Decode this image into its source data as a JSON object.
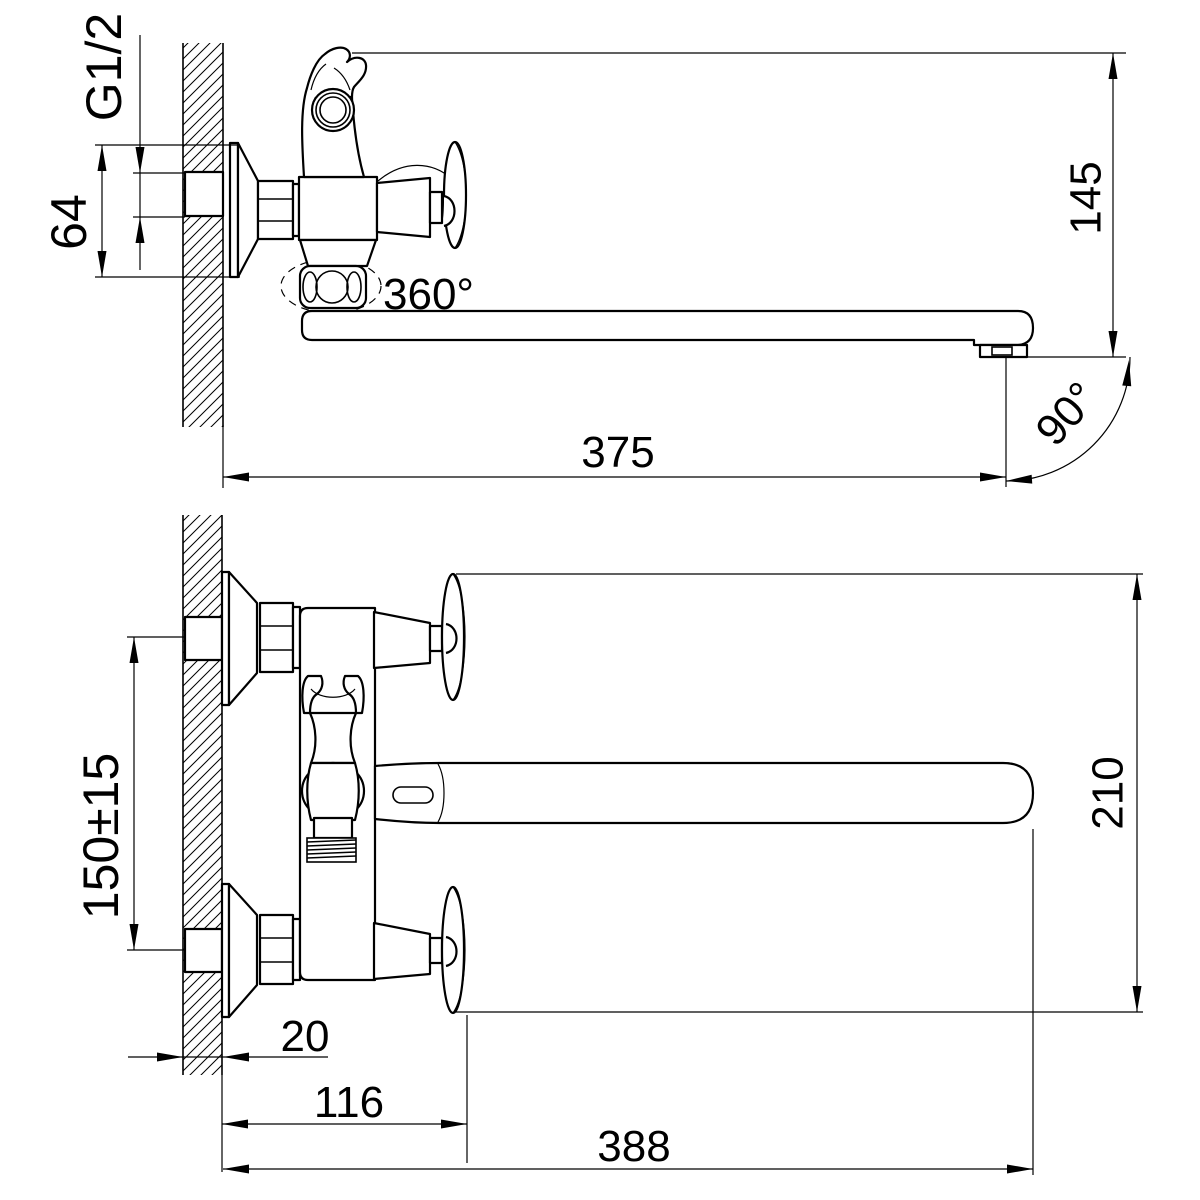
{
  "drawing": {
    "colors": {
      "line": "#000000",
      "background": "#ffffff"
    },
    "side_view": {
      "thread_label": "G1/2",
      "escutcheon_size": "64",
      "spout_height": "145",
      "swivel_angle": "360°",
      "spout_reach": "375",
      "swing_angle": "90°"
    },
    "front_view": {
      "connection_spacing": "150±15",
      "overall_height": "210",
      "wall_thickness": "20",
      "body_depth": "116",
      "overall_length": "388"
    }
  }
}
